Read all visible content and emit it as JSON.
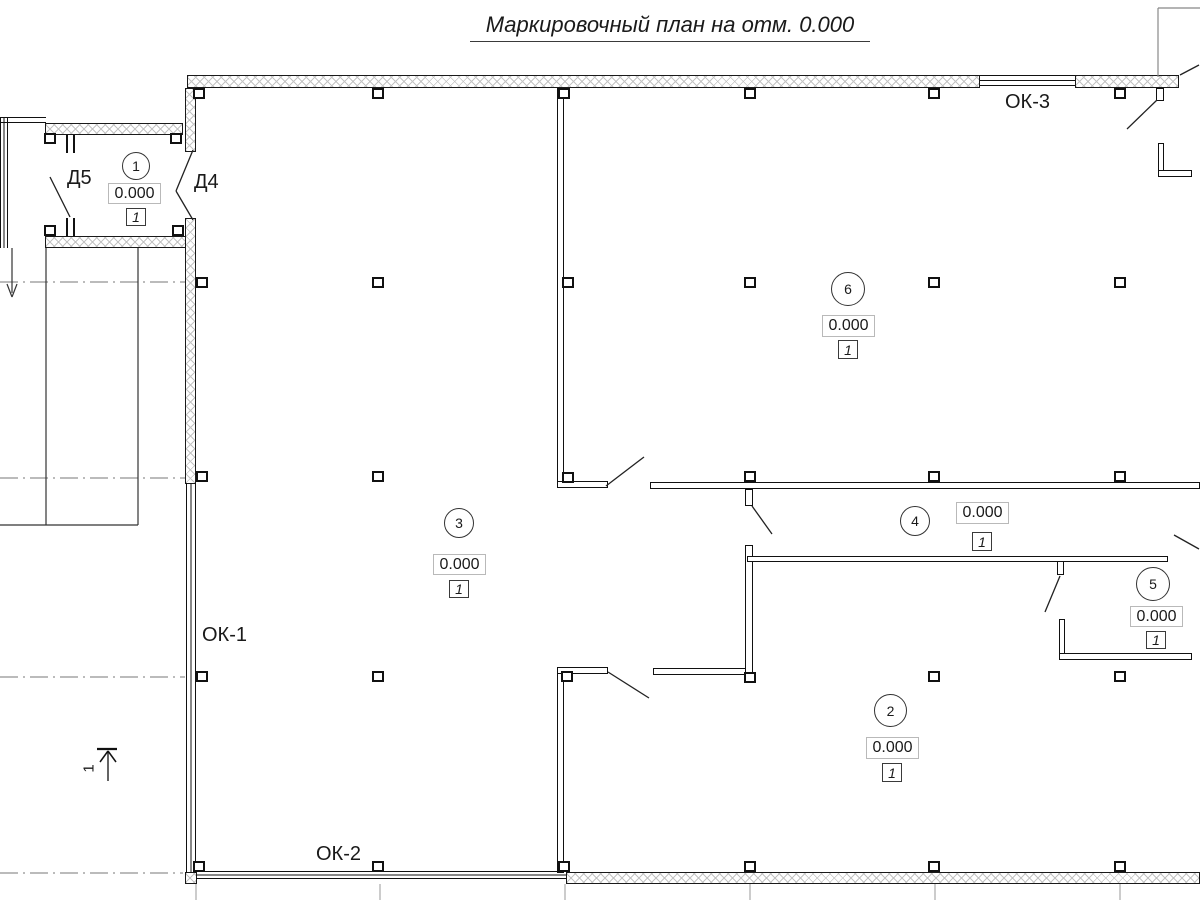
{
  "title": "Маркировочный план на отм. 0.000",
  "windows": {
    "ok1": "ОК-1",
    "ok2": "ОК-2",
    "ok3": "ОК-3"
  },
  "doors": {
    "d4": "Д4",
    "d5": "Д5"
  },
  "section_mark": "1",
  "rooms": [
    {
      "number": "1",
      "elevation": "0.000",
      "finish": "1"
    },
    {
      "number": "2",
      "elevation": "0.000",
      "finish": "1"
    },
    {
      "number": "3",
      "elevation": "0.000",
      "finish": "1"
    },
    {
      "number": "4",
      "elevation": "0.000",
      "finish": "1"
    },
    {
      "number": "5",
      "elevation": "0.000",
      "finish": "1"
    },
    {
      "number": "6",
      "elevation": "0.000",
      "finish": "1"
    }
  ],
  "colors": {
    "line": "#1a1a1a",
    "hatch": "#c4c4c4",
    "grid": "#9a9a9a",
    "axis": "#777777"
  }
}
